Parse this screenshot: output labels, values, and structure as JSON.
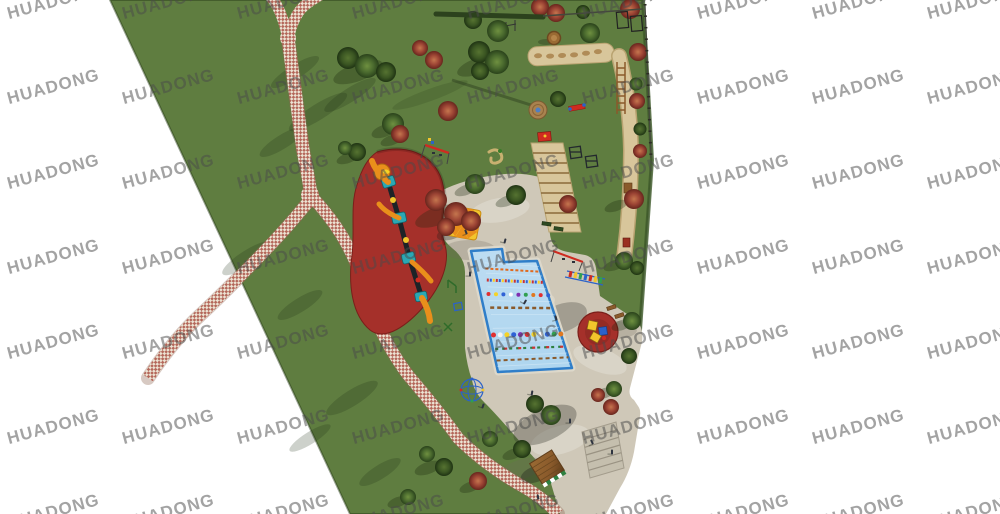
{
  "watermark": {
    "text": "HUADONG",
    "color": "#4a4a4a",
    "opacity": 0.5,
    "font_size_px": 17,
    "rotation_deg": -15,
    "grid": {
      "x_start": 6,
      "y_start": -8,
      "x_step": 115,
      "y_step": 85,
      "cols": 9,
      "rows": 7
    }
  },
  "palette": {
    "background": "#ffffff",
    "grass": "#5f7d40",
    "grass_shadow": "#32491d",
    "path_brick": "#b4675a",
    "path_cream": "#ece3d3",
    "plaza": "#cfc8b8",
    "plaza_step": "#c5bfae",
    "pool_water": "#aed5ef",
    "pool_border": "#2f7ec9",
    "rubber_red": "#a5302a",
    "sand": "#d8c69b",
    "sand_edge": "#b9a371",
    "tree_green": "#4a6a2e",
    "tree_green_dark": "#3a5522",
    "tree_red": "#9c4434",
    "tree_red_light": "#c5764e",
    "wood": "#8a5a2b",
    "equip_orange": "#e98f1b",
    "equip_teal": "#2ba8b4",
    "equip_yellow": "#f2c52c",
    "equip_red": "#cf2b20",
    "equip_blue": "#2b62c9",
    "figure_dark": "#2e3440",
    "fence_dark": "#44483c",
    "hedge_dark": "#2c421d"
  },
  "scene": {
    "type": "park-playground-site-plan-rendering",
    "features": [
      {
        "name": "lawn",
        "color": "grass"
      },
      {
        "name": "brick-walkway",
        "colors": [
          "path_brick",
          "path_cream"
        ]
      },
      {
        "name": "central-plaza",
        "color": "plaza"
      },
      {
        "name": "swimming-pool",
        "color": "pool_water"
      },
      {
        "name": "rubber-play-area",
        "color": "rubber_red"
      },
      {
        "name": "play-structure",
        "colors": [
          "equip_orange",
          "equip_teal"
        ]
      },
      {
        "name": "spinner-circle",
        "color": "rubber_red"
      },
      {
        "name": "sun-umbrella",
        "color": "equip_yellow"
      },
      {
        "name": "balance-log-pit",
        "color": "sand"
      },
      {
        "name": "sand-obstacle-strip",
        "color": "sand"
      },
      {
        "name": "wooden-hut",
        "color": "wood"
      },
      {
        "name": "stairs",
        "color": "plaza_step"
      },
      {
        "name": "green-trees",
        "color": "tree_green"
      },
      {
        "name": "red-trees",
        "color": "tree_red"
      },
      {
        "name": "people",
        "color": "figure_dark"
      }
    ]
  }
}
